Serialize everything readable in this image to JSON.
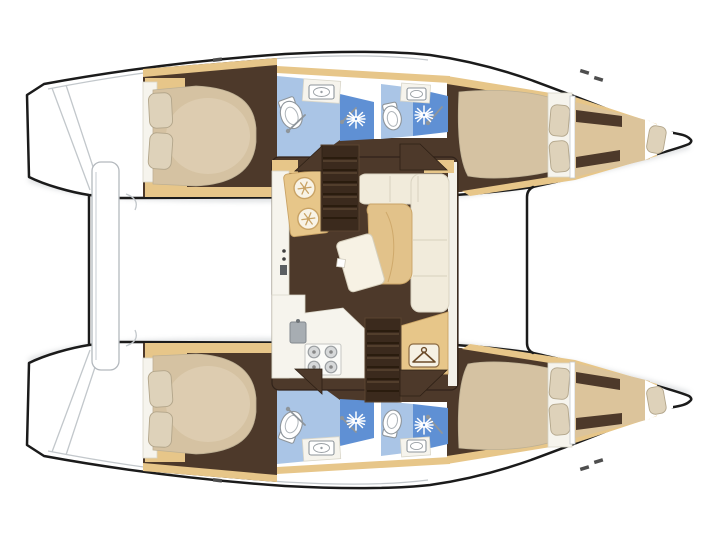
{
  "meta": {
    "title": "Catamaran yacht floor plan",
    "view": "top-down deck / accommodation plan",
    "orientation": "bow pointing right",
    "layout_version": "4 cabins, 4 shower heads, 2 forepeak berths"
  },
  "colors": {
    "outline": "#1b1b1b",
    "deck": "#ffffff",
    "deck_shade": "#c2c7cb",
    "floor": "#4d392a",
    "wood": "#e7c689",
    "wood2": "#e2c28a",
    "wood_stroke": "#c9a365",
    "bed": "#d5c2a2",
    "bed_stroke": "#bdb094",
    "berth": "#dcc49b",
    "pillow": "#ded2ba",
    "pillow_stroke": "#b2a58a",
    "bath": "#aac5e6",
    "shower": "#5f90d4",
    "fixture_stroke": "#8e959b",
    "sofa": "#f1ebdb",
    "sofa_stroke": "#d9d3c1",
    "counter": "#f6f4ed",
    "stair": "#3b2a1d",
    "stair_tread": "#241709",
    "appliance_gray": "#a7adb2"
  },
  "vessel": {
    "type": "sailing catamaran",
    "hulls": [
      {
        "id": "port-hull",
        "position": "top",
        "rooms": [
          {
            "name": "aft cabin",
            "furniture": [
              "island double bed",
              "2 pillows",
              "wardrobe lockers"
            ]
          },
          {
            "name": "aft head",
            "fixtures": [
              "toilet",
              "washbasin",
              "shower stall with handheld shower"
            ]
          },
          {
            "name": "forward head",
            "fixtures": [
              "toilet",
              "washbasin",
              "shower stall with handheld shower"
            ]
          },
          {
            "name": "forward cabin",
            "furniture": [
              "double bed",
              "2 pillows"
            ]
          },
          {
            "name": "forepeak berth",
            "furniture": [
              "single berth",
              "pillow",
              "stowage lockers"
            ]
          }
        ]
      },
      {
        "id": "starboard-hull",
        "position": "bottom",
        "rooms": [
          {
            "name": "aft cabin",
            "furniture": [
              "island double bed",
              "2 pillows",
              "wardrobe lockers"
            ]
          },
          {
            "name": "aft head",
            "fixtures": [
              "toilet",
              "washbasin",
              "shower stall with handheld shower"
            ]
          },
          {
            "name": "forward head",
            "fixtures": [
              "toilet",
              "washbasin",
              "shower stall with handheld shower"
            ]
          },
          {
            "name": "forward cabin",
            "furniture": [
              "double bed",
              "2 pillows"
            ]
          },
          {
            "name": "forepeak berth",
            "furniture": [
              "single berth",
              "pillow",
              "stowage lockers"
            ]
          }
        ]
      }
    ],
    "bridgedeck": {
      "name": "salon and galley",
      "features": [
        {
          "name": "galley",
          "items": [
            "4-burner stove",
            "sink with faucet",
            "twin cold boxes with snowflake marks",
            "L-shaped worktop"
          ]
        },
        {
          "name": "dinette",
          "items": [
            "L-shaped sofa",
            "wood corner table",
            "tilted table leaf"
          ]
        },
        {
          "name": "wardrobe locker",
          "icon": "hanger-icon"
        },
        {
          "name": "port companionway stairs"
        },
        {
          "name": "starboard companionway stairs"
        }
      ]
    },
    "deck_features": [
      "twin transom steps",
      "aft crossbeam with boarding walkway",
      "forward crossbeam line",
      "bow points",
      "deck cleats"
    ]
  },
  "icons": [
    "snowflake-icon",
    "shower-head-icon",
    "hanger-icon",
    "toilet-icon",
    "sink-icon",
    "stove-burner-icon",
    "stairs-icon"
  ]
}
